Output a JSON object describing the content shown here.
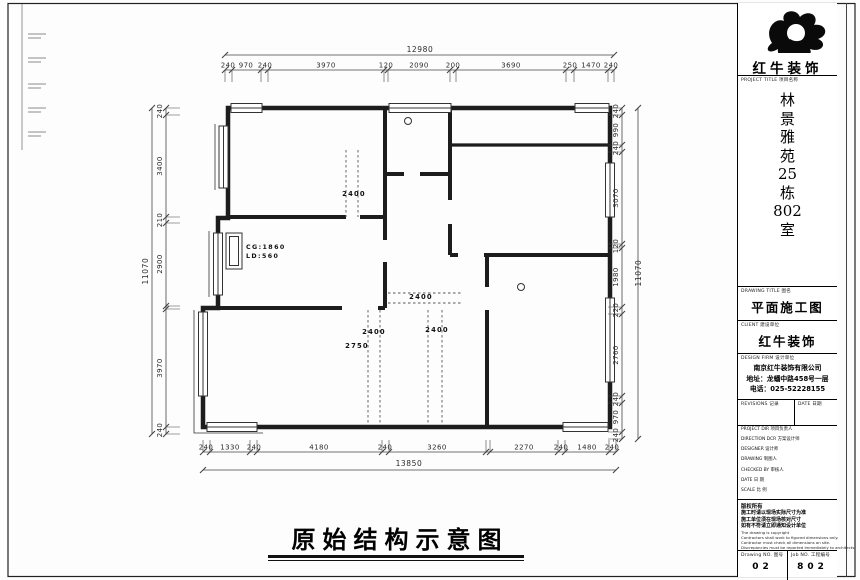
{
  "sheet": {
    "bottom_title": "原始结构示意图"
  },
  "dimensions": {
    "top": {
      "overall": "12980",
      "segments": [
        "240",
        "970",
        "240",
        "3970",
        "120",
        "2090",
        "200",
        "3690",
        "250",
        "1470",
        "240"
      ]
    },
    "bottom": {
      "overall": "13850",
      "segments": [
        "240",
        "1330",
        "240",
        "4180",
        "240",
        "3260",
        "2270",
        "240",
        "1480",
        "240"
      ]
    },
    "left": {
      "overall": "11070",
      "segments": [
        "240",
        "3400",
        "210",
        "2900",
        "3970",
        "240"
      ]
    },
    "right": {
      "overall": "11070",
      "segments": [
        "240",
        "990",
        "240",
        "3070",
        "120",
        "1980",
        "220",
        "2760",
        "240",
        "970",
        "240"
      ]
    }
  },
  "plan_labels": {
    "beam_top": "2400",
    "beam_mid": "2400",
    "beam_left": "2400",
    "beam_leader": "2750",
    "beam_right": "2400",
    "cg": "CG:1860",
    "ld": "LD:560"
  },
  "title_block": {
    "brand": "红牛装饰",
    "project_title_label": "PROJECT TITLE 项目名称",
    "project_name_chars": [
      "林",
      "景",
      "雅",
      "苑",
      "25",
      "栋",
      "802",
      "室"
    ],
    "drawing_title_label": "DRAWING TITLE 图名",
    "drawing_title": "平面施工图",
    "client_label": "CLIENT 建设单位",
    "client": "红牛装饰",
    "design_firm_label": "DESIGN FIRM 设计单位",
    "design_firm_lines": [
      "南京红牛装饰有限公司",
      "地址：龙蟠中路458号一层",
      "电话：025-52228155"
    ],
    "revisions_label": "REVISIONS 记录",
    "date_col_label": "DATE 日期",
    "info_rows": [
      {
        "label": "PROJECT DIR 项目负责人"
      },
      {
        "label": "DIRECTION DCR 方案设计师"
      },
      {
        "label": "DESIGNER 设计师"
      },
      {
        "label": "DRAWING 制图人"
      },
      {
        "label": "CHECKED BY 审核人"
      },
      {
        "label": "DATE 日  期"
      },
      {
        "label": "SCALE 比  例"
      }
    ],
    "notes_header": "版权所有",
    "notes_cn": [
      "施工时请以现场实际尺寸为准",
      "施工单位须在现场核对尺寸",
      "如有不符请立即通知设计单位"
    ],
    "notes_en": [
      "The drawing is copyright",
      "Contractors shall work to figured dimensions only.",
      "Contractor must check all dimensions on site.",
      "Discrepancies must be reported immediately to architects."
    ],
    "drawing_no_label": "Drawing NO. 图号",
    "drawing_no": "02",
    "job_no_label": "Job NO. 工程编号",
    "job_no": "802"
  }
}
